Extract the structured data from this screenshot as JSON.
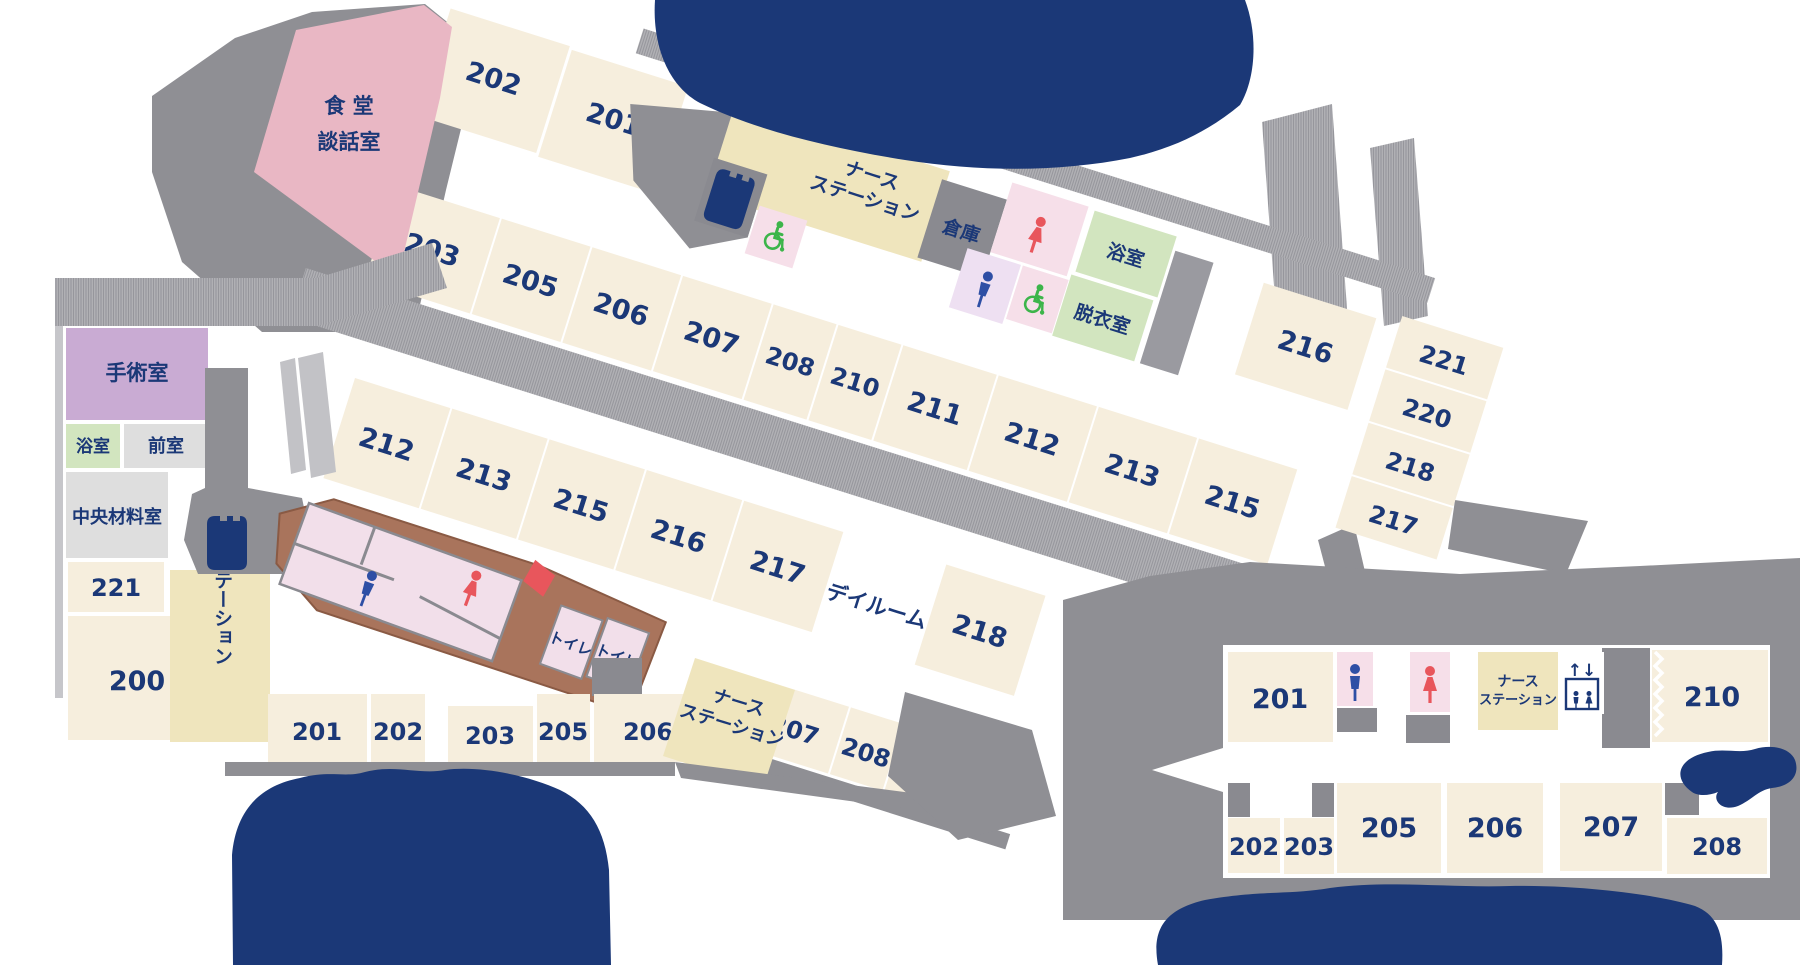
{
  "colors": {
    "navy": "#1b3877",
    "room_fill": "#f6eedd",
    "nurse_fill": "#efe5bd",
    "corridor_gray": "#b2b2b6",
    "block_gray": "#8a8a90",
    "light_gray": "#dedede",
    "dining_pink": "#e9b7c4",
    "surgery_purple": "#c9abd3",
    "bath_green": "#d2e5bf",
    "toilet_pink": "#f6dfe9",
    "wall_brown": "#a9745c",
    "icon_red": "#e8565c",
    "icon_blue": "#2e4fa5",
    "icon_green": "#3cb54a"
  },
  "icons": {
    "wheelchair": "wheelchair-icon",
    "male": "male-person-icon",
    "female": "female-person-icon",
    "elevator": "elevator-icon",
    "stairs": "stairs-icon"
  },
  "ward_top": {
    "dining_line1": "食 堂",
    "dining_line2": "談話室",
    "rooms_north": [
      "202",
      "201"
    ],
    "nurse_line1": "ナース",
    "nurse_line2": "ステーション",
    "storage": "倉庫",
    "bath": "浴室",
    "dressing": "脱衣室",
    "room_216": "216",
    "rooms_east": [
      "221",
      "220",
      "218",
      "217"
    ],
    "rooms_south": [
      "203",
      "205",
      "206",
      "207",
      "208",
      "210",
      "211",
      "212",
      "213",
      "215"
    ]
  },
  "ward_west": {
    "surgery": "手術室",
    "bath": "浴室",
    "anteroom": "前室",
    "central_supply": "中央材料室",
    "room_221": "221",
    "room_200": "200",
    "nurse_station": "ナースステーション"
  },
  "ward_middle": {
    "rooms_north": [
      "212",
      "213",
      "215",
      "216",
      "217",
      "218"
    ],
    "dayroom": "デイルーム",
    "toilet_1": "トイレ",
    "toilet_2": "トイレ",
    "rooms_south_flat": [
      "201",
      "202",
      "203",
      "205",
      "206"
    ],
    "nurse_line1": "ナース",
    "nurse_line2": "ステーション",
    "rooms_south_slope": [
      "207",
      "208",
      "210",
      "211"
    ]
  },
  "ward_new": {
    "room_201": "201",
    "nurse_line1": "ナース",
    "nurse_line2": "ステーション",
    "elevator_arrows": "↑↓",
    "room_210": "210",
    "rooms_south": [
      "202",
      "203",
      "205",
      "206",
      "207",
      "208"
    ]
  }
}
